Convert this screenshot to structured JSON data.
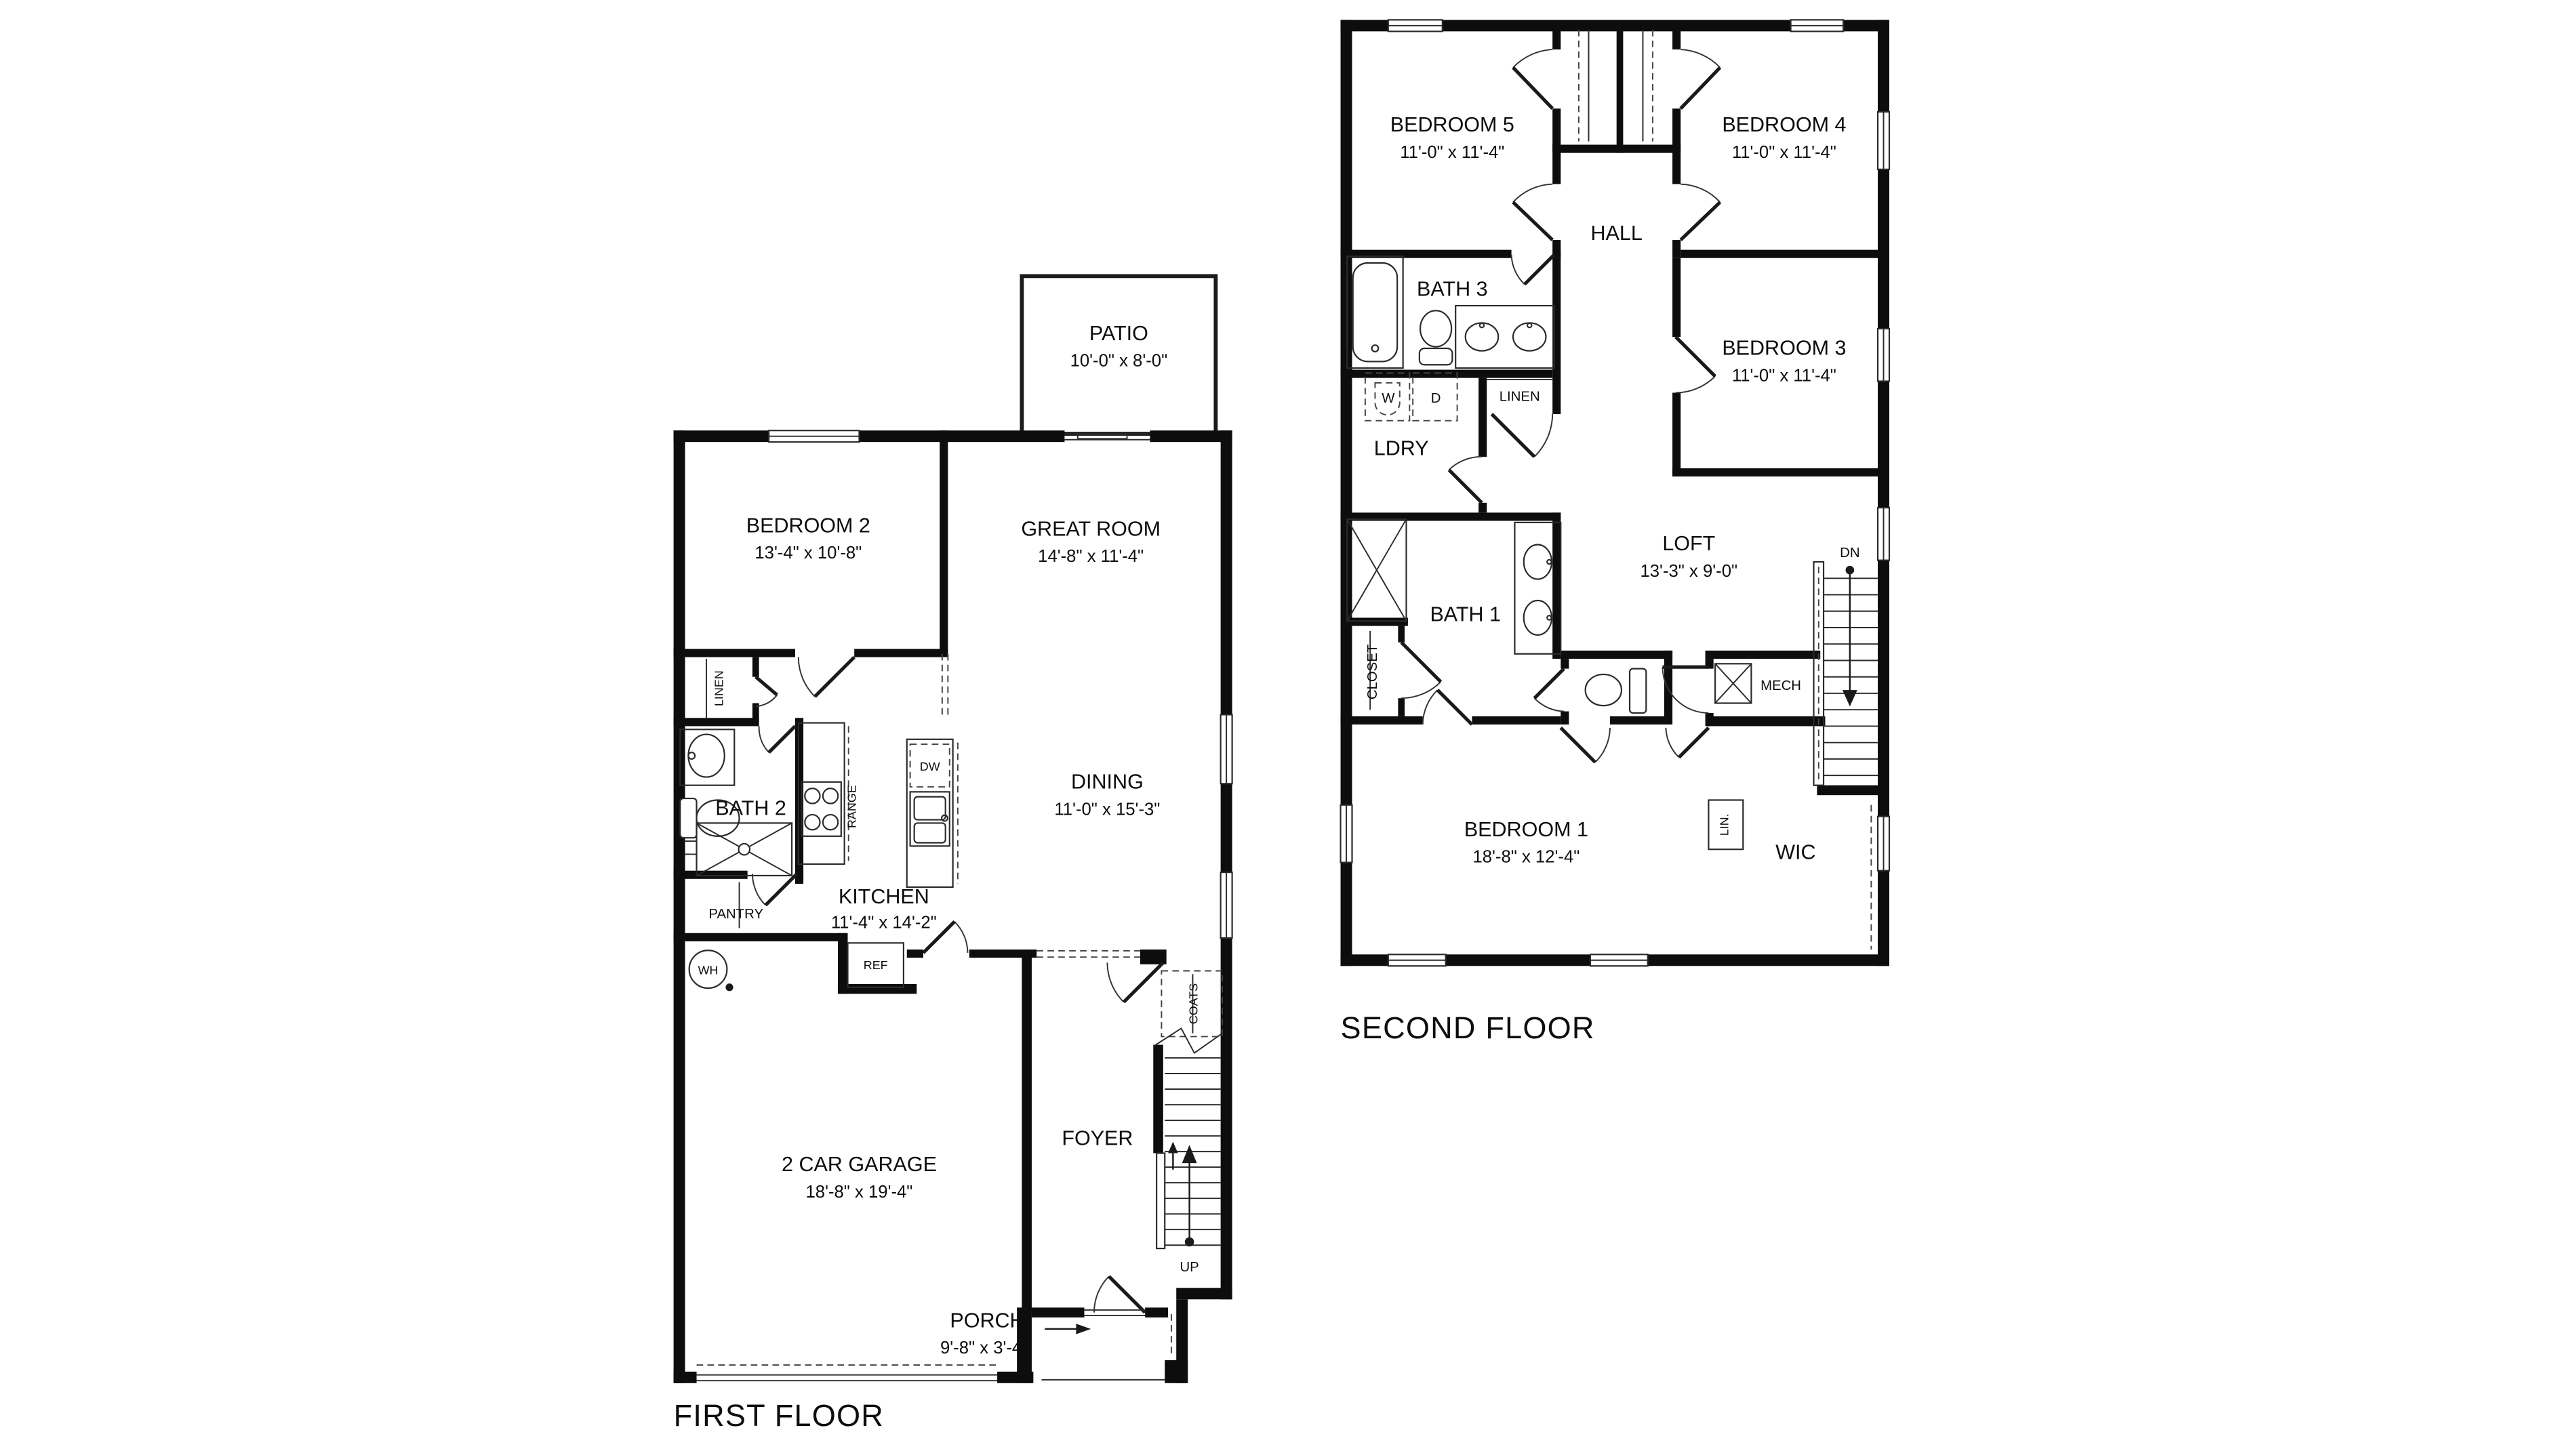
{
  "first_floor": {
    "title": "FIRST FLOOR",
    "rooms": {
      "patio": {
        "name": "PATIO",
        "dims": "10'-0\" x 8'-0\""
      },
      "bedroom2": {
        "name": "BEDROOM 2",
        "dims": "13'-4\" x 10'-8\""
      },
      "great_room": {
        "name": "GREAT ROOM",
        "dims": "14'-8\" x 11'-4\""
      },
      "dining": {
        "name": "DINING",
        "dims": "11'-0\" x 15'-3\""
      },
      "kitchen": {
        "name": "KITCHEN",
        "dims": "11'-4\" x 14'-2\""
      },
      "bath2": {
        "name": "BATH 2"
      },
      "garage": {
        "name": "2 CAR GARAGE",
        "dims": "18'-8\" x 19'-4\""
      },
      "foyer": {
        "name": "FOYER"
      },
      "porch": {
        "name": "PORCH",
        "dims": "9'-8\" x 3'-4\""
      }
    },
    "labels": {
      "linen": "LINEN",
      "pantry": "PANTRY",
      "range": "RANGE",
      "dw": "DW",
      "ref": "REF",
      "wh": "WH",
      "coats": "COATS",
      "up": "UP"
    }
  },
  "second_floor": {
    "title": "SECOND FLOOR",
    "rooms": {
      "bedroom5": {
        "name": "BEDROOM 5",
        "dims": "11'-0\" x 11'-4\""
      },
      "bedroom4": {
        "name": "BEDROOM 4",
        "dims": "11'-0\" x 11'-4\""
      },
      "bedroom3": {
        "name": "BEDROOM 3",
        "dims": "11'-0\" x 11'-4\""
      },
      "bedroom1": {
        "name": "BEDROOM 1",
        "dims": "18'-8\" x 12'-4\""
      },
      "loft": {
        "name": "LOFT",
        "dims": "13'-3\" x 9'-0\""
      },
      "hall": {
        "name": "HALL"
      },
      "bath3": {
        "name": "BATH 3"
      },
      "bath1": {
        "name": "BATH 1"
      },
      "ldry": {
        "name": "LDRY"
      },
      "wic": {
        "name": "WIC"
      }
    },
    "labels": {
      "linen": "LINEN",
      "closet": "CLOSET",
      "mech": "MECH",
      "lin": "LIN.",
      "w": "W",
      "d": "D",
      "dn": "DN"
    }
  }
}
